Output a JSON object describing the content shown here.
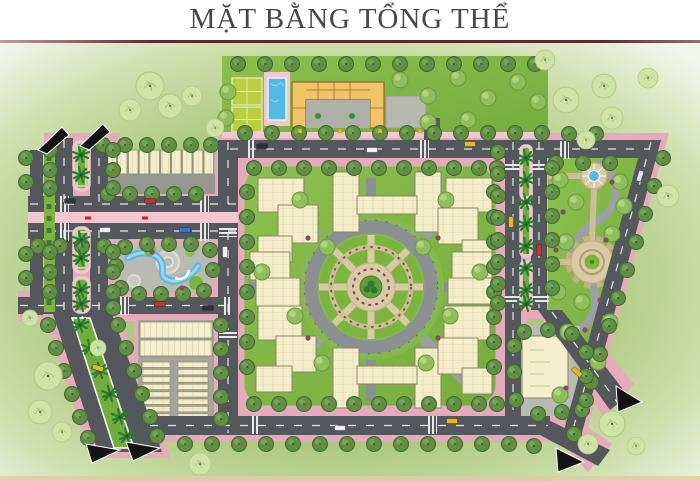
{
  "title": {
    "text": "MẶT BẰNG TỔNG THỂ"
  },
  "plan": {
    "colors": {
      "page_bg": "#ffffff",
      "title_text": "#474747",
      "title_rule": "#5b2b27",
      "bg_inner": "#b4d086",
      "bg_mid": "#aac97c",
      "bg_outer": "#f3f6ec",
      "lawn": "#8cbf4e",
      "lawn_deep": "#74ad3c",
      "road": "#54585c",
      "road_line": "#e8e8e8",
      "sidewalk_pink": "#e7a9bc",
      "sidewalk_pink_light": "#f2c6d2",
      "paving": "#b9bab2",
      "paving_dark": "#a4a69e",
      "plaza_tan": "#d9c9a4",
      "plaza_tan_deep": "#c3b186",
      "building_cream": "#f4eecb",
      "building_line": "#8a8668",
      "facility_yellow": "#f2c368",
      "facility_outline": "#8a6a2a",
      "pool_blue": "#54b8e4",
      "water": "#58b8e0",
      "court_green": "#b9cf3f",
      "tree_green": "#5f8f45",
      "tree_green_dark": "#40662e",
      "tree_light": "#8fbf5b",
      "tree_soft": "#cfe3a6",
      "palm_green": "#2e7a33",
      "median_green": "#6fae3a",
      "flower": "#8a4a62",
      "accent_red": "#cc2020",
      "gate": "#141414",
      "taxi": "#e8b51e",
      "strip_tan": "#d8cfa4"
    }
  },
  "scene": {
    "street_trees": [
      [
        245,
        133
      ],
      [
        272,
        133
      ],
      [
        299,
        133
      ],
      [
        326,
        133
      ],
      [
        353,
        133
      ],
      [
        380,
        133
      ],
      [
        407,
        133
      ],
      [
        434,
        133
      ],
      [
        461,
        133
      ],
      [
        488,
        133
      ],
      [
        515,
        133
      ],
      [
        542,
        133
      ],
      [
        569,
        134
      ],
      [
        596,
        134
      ],
      [
        556,
        163
      ],
      [
        583,
        163
      ],
      [
        610,
        163
      ],
      [
        238,
        64
      ],
      [
        265,
        64
      ],
      [
        292,
        64
      ],
      [
        319,
        64
      ],
      [
        346,
        64
      ],
      [
        373,
        64
      ],
      [
        400,
        64
      ],
      [
        427,
        64
      ],
      [
        454,
        64
      ],
      [
        481,
        64
      ],
      [
        508,
        64
      ],
      [
        535,
        64
      ],
      [
        254,
        168
      ],
      [
        279,
        168
      ],
      [
        304,
        168
      ],
      [
        329,
        168
      ],
      [
        354,
        168
      ],
      [
        379,
        168
      ],
      [
        404,
        168
      ],
      [
        429,
        168
      ],
      [
        454,
        168
      ],
      [
        479,
        168
      ],
      [
        497,
        168
      ],
      [
        254,
        404
      ],
      [
        279,
        404
      ],
      [
        304,
        404
      ],
      [
        329,
        404
      ],
      [
        354,
        404
      ],
      [
        379,
        404
      ],
      [
        404,
        404
      ],
      [
        429,
        404
      ],
      [
        454,
        404
      ],
      [
        479,
        404
      ],
      [
        497,
        404
      ],
      [
        247,
        192
      ],
      [
        247,
        217
      ],
      [
        247,
        242
      ],
      [
        247,
        267
      ],
      [
        247,
        292
      ],
      [
        247,
        317
      ],
      [
        247,
        342
      ],
      [
        247,
        367
      ],
      [
        494,
        192
      ],
      [
        494,
        217
      ],
      [
        494,
        242
      ],
      [
        494,
        267
      ],
      [
        494,
        292
      ],
      [
        494,
        317
      ],
      [
        494,
        342
      ],
      [
        494,
        367
      ],
      [
        185,
        444
      ],
      [
        212,
        444
      ],
      [
        239,
        444
      ],
      [
        266,
        444
      ],
      [
        293,
        444
      ],
      [
        320,
        444
      ],
      [
        347,
        444
      ],
      [
        374,
        444
      ],
      [
        401,
        444
      ],
      [
        428,
        444
      ],
      [
        455,
        444
      ],
      [
        482,
        444
      ],
      [
        509,
        444
      ],
      [
        534,
        446
      ],
      [
        103,
        145
      ],
      [
        125,
        145
      ],
      [
        147,
        145
      ],
      [
        169,
        145
      ],
      [
        191,
        145
      ],
      [
        211,
        145
      ],
      [
        108,
        194
      ],
      [
        130,
        194
      ],
      [
        152,
        194
      ],
      [
        174,
        194
      ],
      [
        196,
        194
      ],
      [
        38,
        246
      ],
      [
        60,
        246
      ],
      [
        82,
        246
      ],
      [
        104,
        246
      ],
      [
        125,
        247
      ],
      [
        147,
        244
      ],
      [
        169,
        244
      ],
      [
        191,
        244
      ],
      [
        210,
        250
      ],
      [
        213,
        270
      ],
      [
        204,
        291
      ],
      [
        183,
        294
      ],
      [
        161,
        294
      ],
      [
        139,
        294
      ],
      [
        121,
        288
      ],
      [
        116,
        266
      ],
      [
        50,
        150
      ],
      [
        50,
        170
      ],
      [
        50,
        188
      ],
      [
        50,
        252
      ],
      [
        50,
        272
      ],
      [
        50,
        292
      ],
      [
        113,
        150
      ],
      [
        113,
        170
      ],
      [
        113,
        188
      ],
      [
        113,
        252
      ],
      [
        113,
        272
      ],
      [
        113,
        292
      ],
      [
        113,
        308
      ],
      [
        26,
        158
      ],
      [
        26,
        182
      ],
      [
        26,
        254
      ],
      [
        26,
        278
      ],
      [
        48,
        325
      ],
      [
        56,
        348
      ],
      [
        64,
        371
      ],
      [
        72,
        394
      ],
      [
        80,
        417
      ],
      [
        88,
        438
      ],
      [
        118,
        325
      ],
      [
        126,
        348
      ],
      [
        134,
        371
      ],
      [
        142,
        394
      ],
      [
        150,
        417
      ],
      [
        157,
        436
      ],
      [
        221,
        325
      ],
      [
        221,
        349
      ],
      [
        221,
        373
      ],
      [
        221,
        397
      ],
      [
        221,
        419
      ],
      [
        498,
        152
      ],
      [
        498,
        174
      ],
      [
        498,
        196
      ],
      [
        498,
        218
      ],
      [
        498,
        240
      ],
      [
        498,
        262
      ],
      [
        498,
        284
      ],
      [
        498,
        303
      ],
      [
        552,
        168
      ],
      [
        552,
        192
      ],
      [
        552,
        216
      ],
      [
        552,
        240
      ],
      [
        552,
        264
      ],
      [
        552,
        288
      ],
      [
        663,
        158
      ],
      [
        654,
        186
      ],
      [
        645,
        214
      ],
      [
        636,
        242
      ],
      [
        627,
        270
      ],
      [
        618,
        298
      ],
      [
        609,
        326
      ],
      [
        600,
        354
      ],
      [
        591,
        382
      ],
      [
        582,
        410
      ],
      [
        574,
        434
      ],
      [
        524,
        332
      ],
      [
        548,
        330
      ],
      [
        572,
        334
      ],
      [
        586,
        352
      ],
      [
        586,
        376
      ],
      [
        586,
        400
      ],
      [
        562,
        412
      ],
      [
        538,
        414
      ],
      [
        516,
        400
      ],
      [
        514,
        372
      ],
      [
        514,
        346
      ]
    ],
    "block_trees": [
      [
        300,
        200
      ],
      [
        327,
        247
      ],
      [
        295,
        316
      ],
      [
        322,
        363
      ],
      [
        446,
        200
      ],
      [
        423,
        247
      ],
      [
        450,
        316
      ],
      [
        426,
        363
      ],
      [
        262,
        272
      ],
      [
        480,
        272
      ],
      [
        400,
        80
      ],
      [
        428,
        96
      ],
      [
        458,
        78
      ],
      [
        488,
        98
      ],
      [
        518,
        82
      ],
      [
        538,
        102
      ],
      [
        468,
        120
      ],
      [
        428,
        122
      ],
      [
        228,
        92
      ],
      [
        226,
        118
      ],
      [
        560,
        180
      ],
      [
        576,
        202
      ],
      [
        566,
        242
      ],
      [
        612,
        234
      ],
      [
        624,
        206
      ],
      [
        582,
        302
      ],
      [
        610,
        322
      ],
      [
        568,
        332
      ],
      [
        598,
        362
      ],
      [
        558,
        292
      ],
      [
        620,
        182
      ],
      [
        560,
        395
      ]
    ],
    "soft_trees": [
      [
        150,
        86,
        14
      ],
      [
        170,
        106,
        12
      ],
      [
        130,
        110,
        11
      ],
      [
        192,
        96,
        10
      ],
      [
        215,
        128,
        9
      ],
      [
        545,
        60,
        10
      ],
      [
        566,
        100,
        13
      ],
      [
        604,
        86,
        12
      ],
      [
        612,
        118,
        11
      ],
      [
        586,
        140,
        9
      ],
      [
        648,
        78,
        10
      ],
      [
        668,
        196,
        11
      ],
      [
        30,
        318,
        8
      ],
      [
        48,
        376,
        14
      ],
      [
        40,
        412,
        12
      ],
      [
        62,
        432,
        10
      ],
      [
        98,
        348,
        8
      ],
      [
        200,
        464,
        11
      ],
      [
        588,
        444,
        10
      ],
      [
        612,
        424,
        13
      ],
      [
        636,
        446,
        9
      ]
    ],
    "palms": [
      [
        81,
        155
      ],
      [
        81,
        175
      ],
      [
        81,
        240
      ],
      [
        81,
        258
      ],
      [
        81,
        290
      ],
      [
        81,
        304
      ],
      [
        80,
        325
      ],
      [
        90,
        348
      ],
      [
        100,
        371
      ],
      [
        110,
        394
      ],
      [
        120,
        417
      ],
      [
        127,
        436
      ],
      [
        526,
        158
      ],
      [
        526,
        180
      ],
      [
        526,
        202
      ],
      [
        526,
        224
      ],
      [
        526,
        246
      ],
      [
        526,
        268
      ],
      [
        526,
        290
      ],
      [
        526,
        304
      ]
    ],
    "cars": [
      [
        262,
        146,
        "#2e2e34",
        0
      ],
      [
        372,
        150,
        "#f0f0f0",
        0
      ],
      [
        470,
        144,
        "#e8b51e",
        0
      ],
      [
        586,
        147,
        "#5078c8",
        0
      ],
      [
        70,
        201,
        "#33343a",
        0
      ],
      [
        150,
        201,
        "#c03434",
        0
      ],
      [
        105,
        230,
        "#f0f0f0",
        0
      ],
      [
        185,
        230,
        "#3a6fd8",
        0
      ],
      [
        160,
        304,
        "#c03434",
        0
      ],
      [
        208,
        308,
        "#2f2f35",
        0
      ],
      [
        340,
        428,
        "#f0f0f0",
        0
      ],
      [
        452,
        421,
        "#e8b51e",
        0
      ],
      [
        511,
        222,
        "#e8b51e",
        90
      ],
      [
        539,
        250,
        "#c03434",
        90
      ],
      [
        225,
        252,
        "#f0f0f0",
        90
      ],
      [
        577,
        372,
        "#e8b51e",
        42
      ],
      [
        640,
        176,
        "#dde0ea",
        -72
      ],
      [
        98,
        368,
        "#e8b51e",
        17
      ]
    ],
    "gates": [
      [
        [
          38,
          150
        ],
        [
          62,
          127
        ],
        [
          69,
          135
        ],
        [
          47,
          154
        ]
      ],
      [
        [
          80,
          146
        ],
        [
          103,
          124
        ],
        [
          110,
          132
        ],
        [
          89,
          150
        ]
      ],
      [
        [
          86,
          444
        ],
        [
          120,
          450
        ],
        [
          92,
          463
        ]
      ],
      [
        [
          126,
          442
        ],
        [
          160,
          448
        ],
        [
          133,
          461
        ]
      ],
      [
        [
          616,
          386
        ],
        [
          642,
          402
        ],
        [
          618,
          412
        ]
      ],
      [
        [
          556,
          448
        ],
        [
          584,
          462
        ],
        [
          558,
          472
        ]
      ]
    ],
    "lights": [
      [
        300,
        131
      ],
      [
        340,
        131
      ],
      [
        380,
        131
      ],
      [
        420,
        131
      ]
    ],
    "flowers": [
      [
        563,
        212
      ],
      [
        606,
        240
      ],
      [
        585,
        330
      ],
      [
        566,
        388
      ],
      [
        612,
        182
      ],
      [
        600,
        300
      ],
      [
        556,
        250
      ],
      [
        308,
        238
      ],
      [
        438,
        238
      ],
      [
        308,
        338
      ],
      [
        438,
        338
      ],
      [
        152,
        252
      ],
      [
        182,
        288
      ]
    ],
    "red_accents": [
      [
        88,
        218
      ],
      [
        145,
        218
      ]
    ],
    "crosswalks": [
      [
        246,
        140,
        "v"
      ],
      [
        420,
        140,
        "v"
      ],
      [
        560,
        141,
        "v"
      ],
      [
        60,
        196,
        "v"
      ],
      [
        200,
        196,
        "v"
      ],
      [
        60,
        223,
        "v"
      ],
      [
        200,
        223,
        "v"
      ],
      [
        120,
        297,
        "v"
      ],
      [
        222,
        297,
        "v"
      ],
      [
        250,
        416,
        "v"
      ],
      [
        428,
        416,
        "v"
      ],
      [
        219,
        228,
        "h"
      ],
      [
        219,
        330,
        "h"
      ],
      [
        505,
        162,
        "h"
      ],
      [
        531,
        162,
        "h"
      ],
      [
        505,
        294,
        "h"
      ],
      [
        531,
        294,
        "h"
      ]
    ]
  }
}
